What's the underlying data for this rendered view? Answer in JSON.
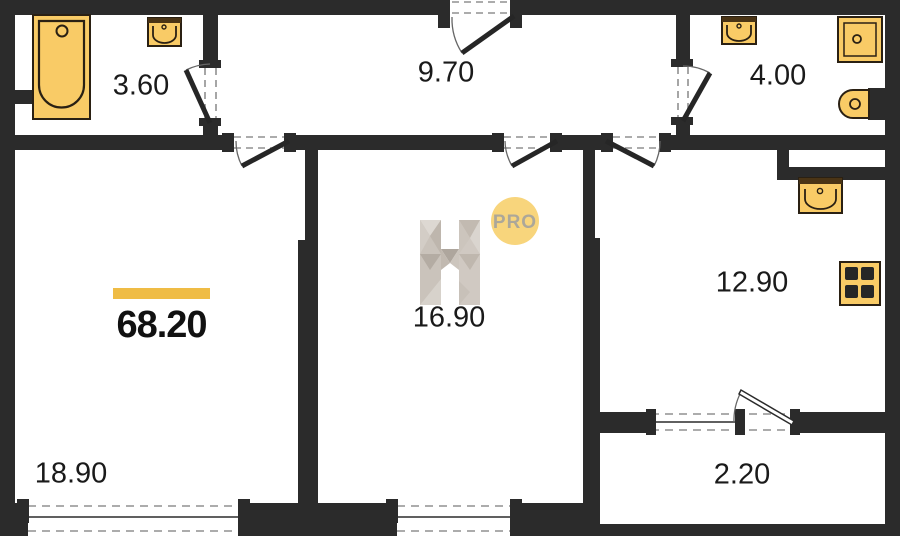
{
  "plan": {
    "total_area": "68.20",
    "rooms": [
      {
        "name": "bathroom",
        "area": "3.60"
      },
      {
        "name": "hallway",
        "area": "9.70"
      },
      {
        "name": "toilet",
        "area": "4.00"
      },
      {
        "name": "room",
        "area": "16.90"
      },
      {
        "name": "kitchen",
        "area": "12.90"
      },
      {
        "name": "living-room",
        "area": "18.90"
      },
      {
        "name": "balcony",
        "area": "2.20"
      }
    ]
  },
  "brand": {
    "pro_label": "PRO"
  },
  "colors": {
    "wall": "#2b2b2b",
    "fixture_fill": "#f9cb66",
    "fixture_stroke": "#2a2013",
    "accent_bar": "#efbc45",
    "logo_circle": "#f8d57c",
    "logo_text": "#aca799",
    "watermark_gray": "#ccc5bd"
  }
}
